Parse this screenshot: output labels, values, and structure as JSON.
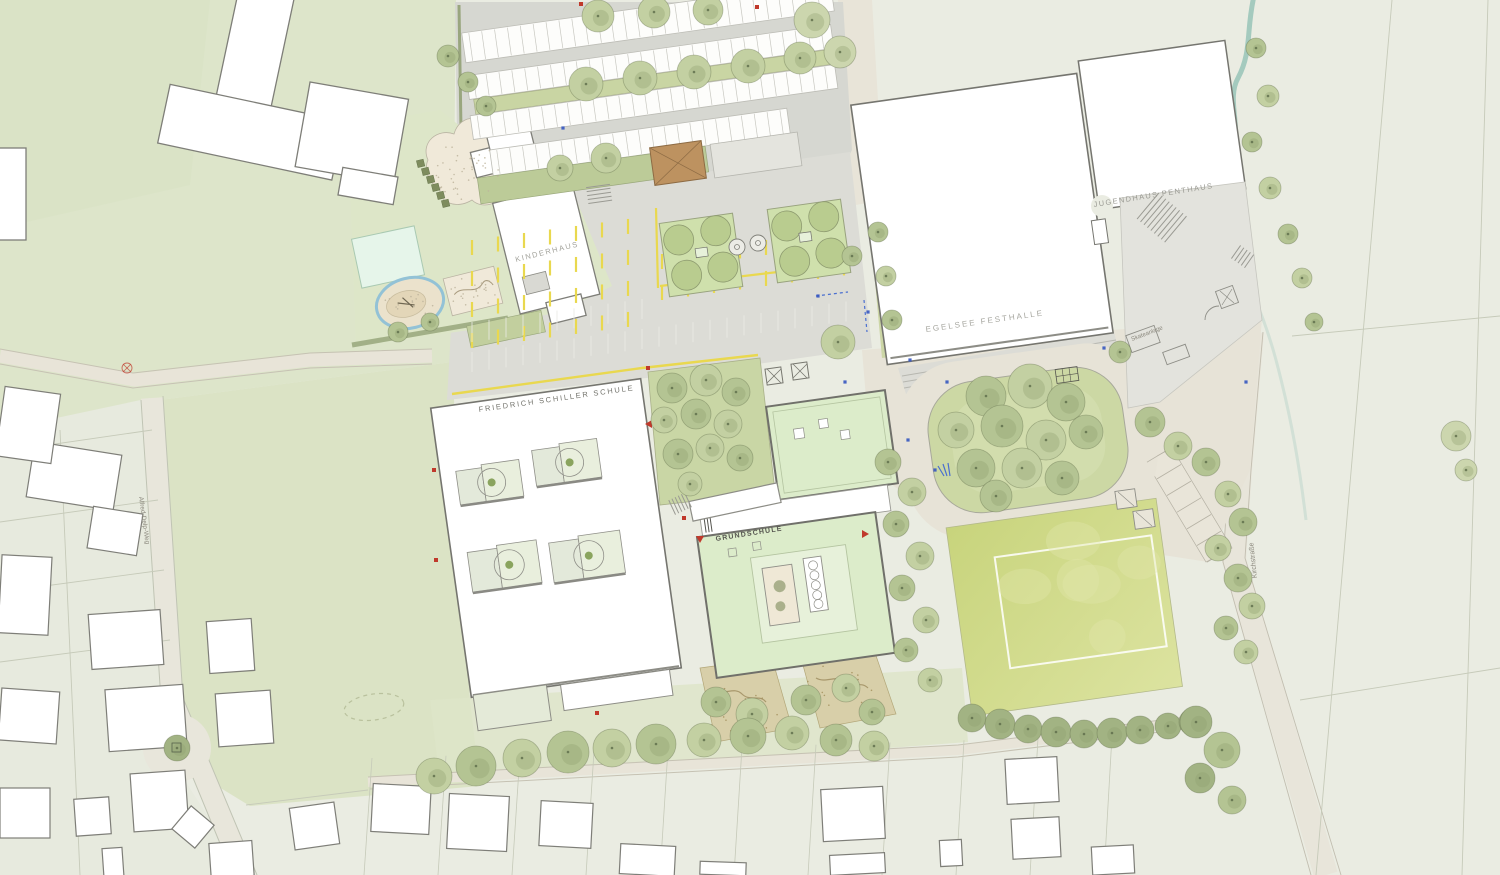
{
  "plan": {
    "buildings": {
      "friedrich_schiller_schule": "FRIEDRICH SCHILLER SCHULE",
      "grundschule": "GRUNDSCHULE",
      "kinderhaus": "KINDERHAUS",
      "egelsee_festhalle": "EGELSEE FESTHALLE",
      "jugendhaus_penthaus": "JUGENDHAUS PENTHAUS"
    },
    "streets": {
      "alfred_delp_weg": "Alfred-Delp-Weg",
      "kirchstrasse": "Kirchstraße"
    },
    "areas": {
      "skateanlage": "Skateanlage"
    },
    "colors": {
      "background": "#eaece2",
      "park_green": "#dde5ca",
      "lawn_green": "#dbe3c5",
      "grass_dark": "#ccd8a4",
      "building_white": "#ffffff",
      "building_outline": "#75756f",
      "roof_green": "#dcecca",
      "asphalt": "#d6d7d1",
      "schoolyard_gray": "#dcdcd6",
      "path_beige": "#e8e4d8",
      "marking_yellow": "#e9d84f",
      "sports_field": "#c8d47c",
      "tree_green": "#b4c493",
      "water_blue": "#9cc6ba",
      "pond_ring_blue": "#93c2d6",
      "pool_mint": "#e6f5ea",
      "sand": "#f0e9d9",
      "wood_brown": "#bd9260",
      "accent_red": "#c0392b",
      "accent_blue": "#3556c0"
    }
  }
}
